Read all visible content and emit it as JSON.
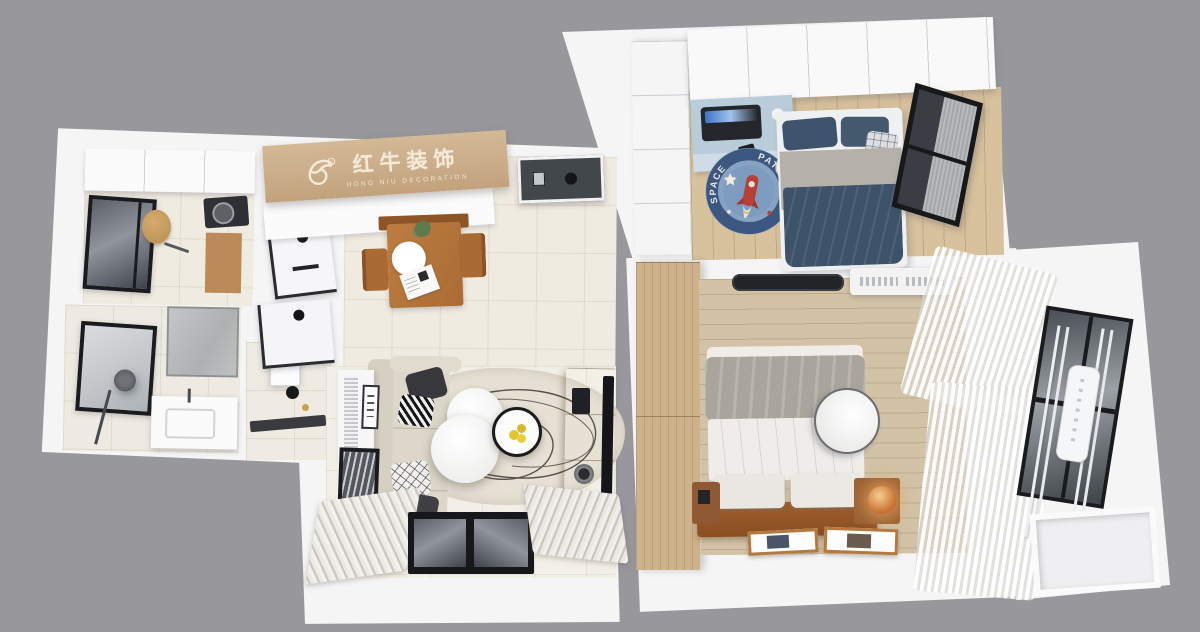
{
  "scene": {
    "description": "3D top-down interior floor plan render",
    "background_color": "#98979c",
    "plan_color": "#f5f5f6"
  },
  "branding": {
    "logo_cn": "红牛装饰",
    "logo_en": "HONG NIU DECORATION",
    "registered_mark": "®",
    "beam_color": "#c9ac88",
    "text_color": "#f2e9d6"
  },
  "kids_rug": {
    "text_left": "SPACE",
    "text_right": "PATROL",
    "base_color": "#7e9cc0",
    "ring_color": "#3c5880",
    "rocket_color": "#b84038"
  },
  "palette": {
    "tile_floor": "#f0ebe1",
    "kids_wood_floor": "#d8c19d",
    "master_wood_floor": "#d2c2a6",
    "wardrobe_wood": "#cdb28c",
    "tv_cabinet_wood": "#9e6136",
    "dining_wood": "#b5763c",
    "kids_blue": "#ccd6e0",
    "desk_blue": "#b9ccd9",
    "navy_bedding": "#3e5269",
    "charcoal": "#3c3d41",
    "amber_lamp": "#c96f2f",
    "sofa_beige": "#dbd5c8"
  }
}
